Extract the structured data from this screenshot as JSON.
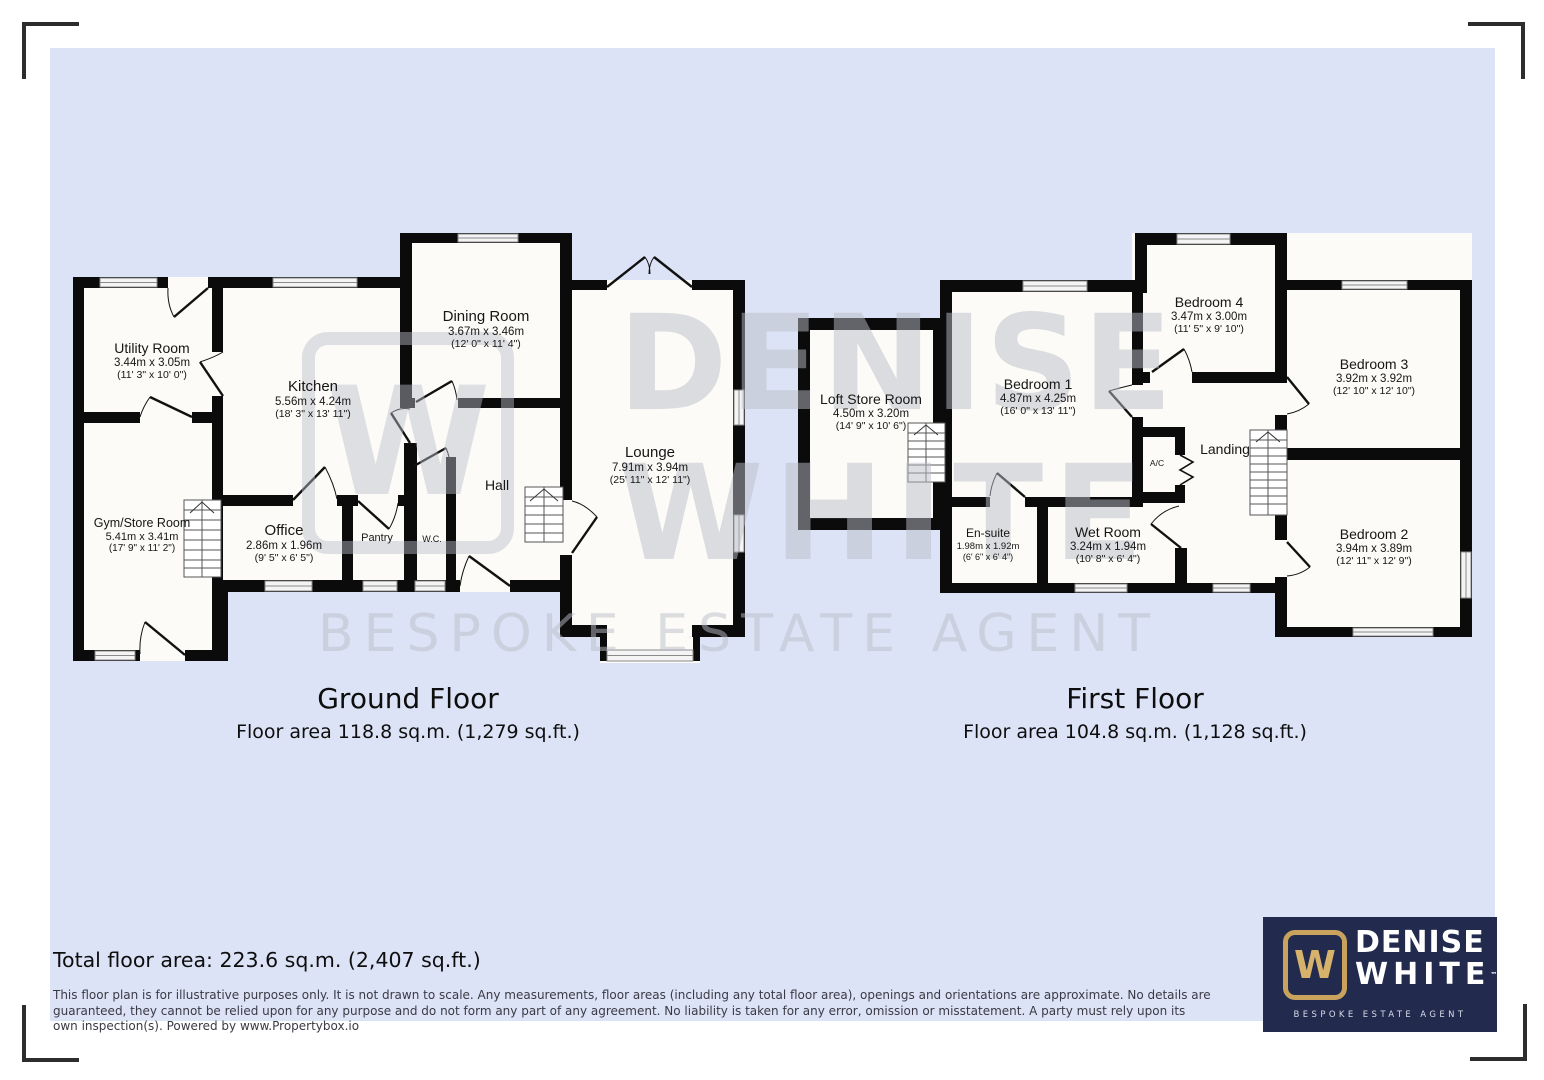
{
  "watermark": {
    "brand_initial": "W",
    "line1": "DENISE",
    "line2": "WHITE",
    "line3": "BESPOKE ESTATE AGENT"
  },
  "ground_floor": {
    "title": "Ground Floor",
    "area_line": "Floor area 118.8 sq.m. (1,279 sq.ft.)",
    "rooms": {
      "utility": {
        "name": "Utility Room",
        "metric": "3.44m x 3.05m",
        "imperial": "(11' 3\" x 10' 0\")"
      },
      "gym": {
        "name": "Gym/Store Room",
        "metric": "5.41m x 3.41m",
        "imperial": "(17' 9\" x 11' 2\")"
      },
      "kitchen": {
        "name": "Kitchen",
        "metric": "5.56m x 4.24m",
        "imperial": "(18' 3\" x 13' 11\")"
      },
      "office": {
        "name": "Office",
        "metric": "2.86m x 1.96m",
        "imperial": "(9' 5\" x 6' 5\")"
      },
      "pantry": {
        "name": "Pantry"
      },
      "wc": {
        "name": "W.C."
      },
      "hall": {
        "name": "Hall"
      },
      "dining": {
        "name": "Dining Room",
        "metric": "3.67m x 3.46m",
        "imperial": "(12' 0\" x 11' 4\")"
      },
      "lounge": {
        "name": "Lounge",
        "metric": "7.91m x 3.94m",
        "imperial": "(25' 11\" x 12' 11\")"
      }
    }
  },
  "first_floor": {
    "title": "First Floor",
    "area_line": "Floor area 104.8 sq.m. (1,128 sq.ft.)",
    "rooms": {
      "loft": {
        "name": "Loft Store Room",
        "metric": "4.50m x 3.20m",
        "imperial": "(14' 9\" x 10' 6\")"
      },
      "bedroom1": {
        "name": "Bedroom 1",
        "metric": "4.87m x 4.25m",
        "imperial": "(16' 0\" x 13' 11\")"
      },
      "bedroom4": {
        "name": "Bedroom 4",
        "metric": "3.47m x 3.00m",
        "imperial": "(11' 5\" x 9' 10\")"
      },
      "bedroom3": {
        "name": "Bedroom 3",
        "metric": "3.92m x 3.92m",
        "imperial": "(12' 10\" x 12' 10\")"
      },
      "bedroom2": {
        "name": "Bedroom 2",
        "metric": "3.94m x 3.89m",
        "imperial": "(12' 11\" x 12' 9\")"
      },
      "landing": {
        "name": "Landing"
      },
      "ac": {
        "name": "A/C"
      },
      "ensuite": {
        "name": "En-suite",
        "metric": "1.98m x 1.92m",
        "imperial": "(6' 6\" x 6' 4\")"
      },
      "wetroom": {
        "name": "Wet Room",
        "metric": "3.24m x 1.94m",
        "imperial": "(10' 8\" x 6' 4\")"
      }
    }
  },
  "summary": {
    "total_area": "Total floor area: 223.6 sq.m. (2,407 sq.ft.)"
  },
  "disclaimer": "This floor plan is for illustrative purposes only. It is not drawn to scale. Any measurements, floor areas (including any total floor area), openings and orientations are approximate. No details are guaranteed, they cannot be relied upon for any purpose and do not form any part of any agreement. No liability is taken for any error, omission or misstatement. A party must rely upon its own inspection(s). Powered by www.Propertybox.io",
  "logo": {
    "brand_initial": "W",
    "name_line1": "DENISE",
    "name_line2": "WHITE",
    "tm": "™",
    "tagline": "BESPOKE ESTATE AGENT",
    "navy": "#222b4e",
    "gold": "#c9a35d"
  }
}
